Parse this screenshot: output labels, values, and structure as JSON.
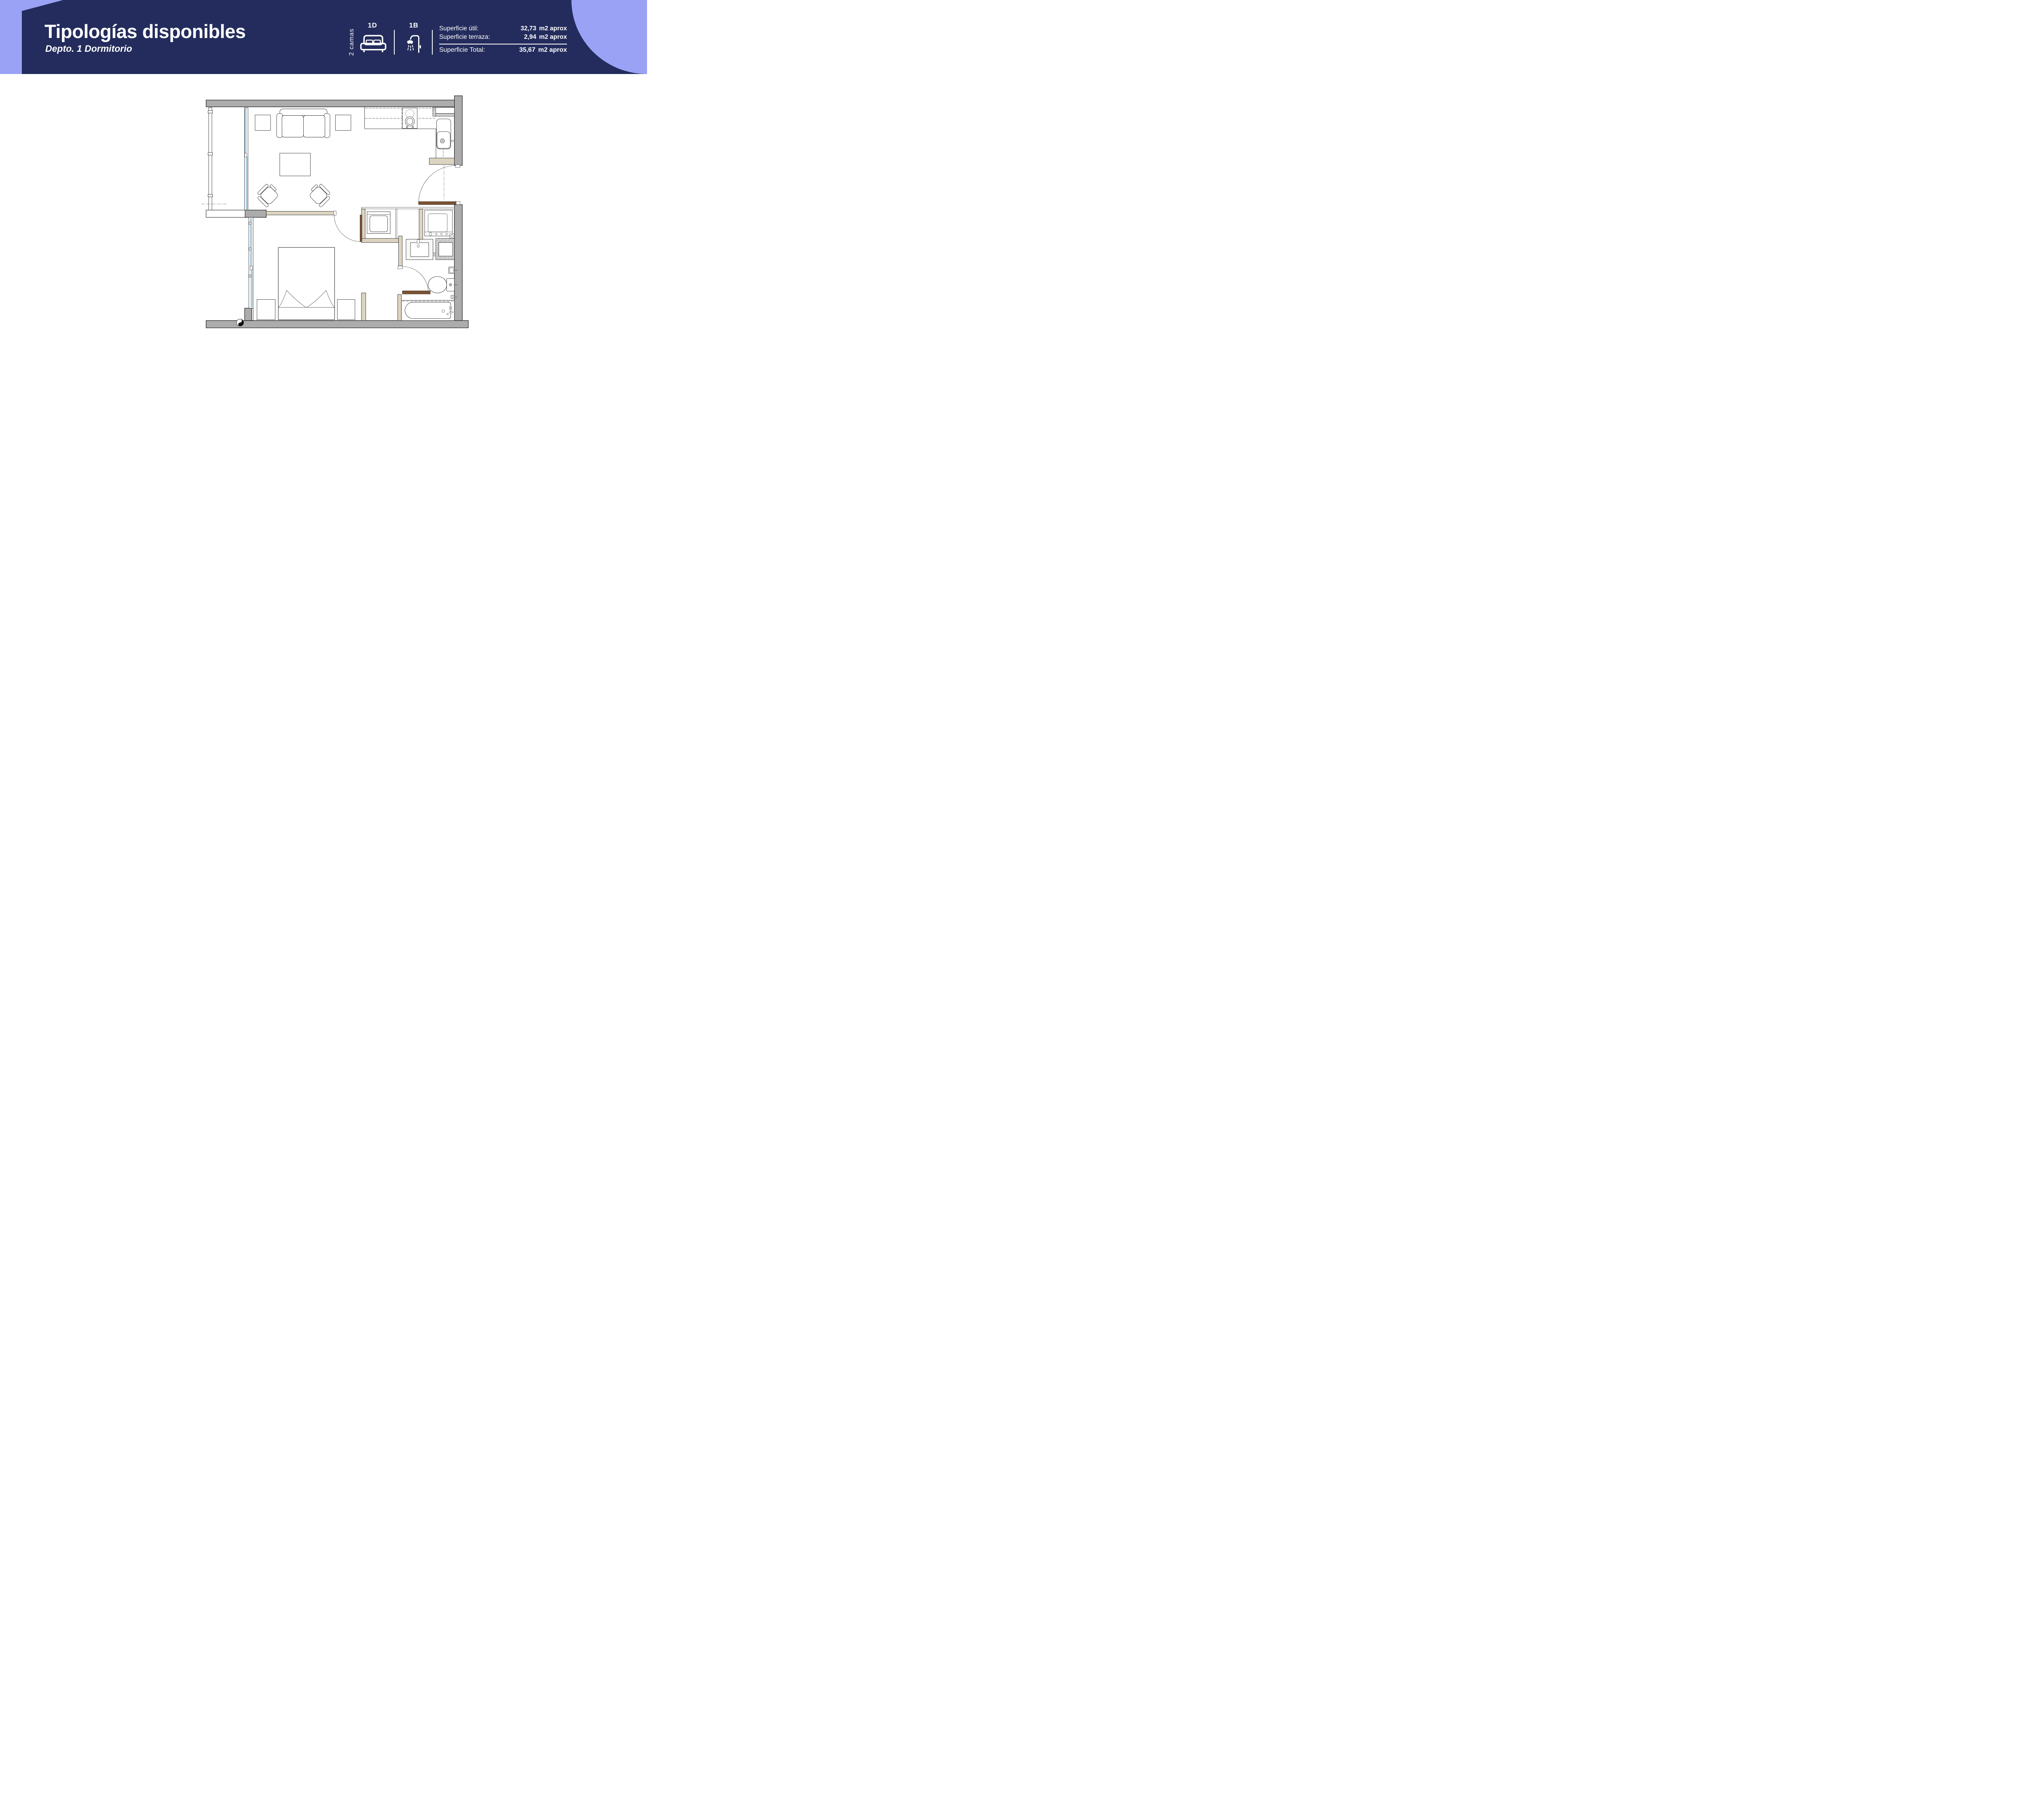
{
  "header": {
    "title": "Tipologías disponibles",
    "subtitle": "Depto. 1 Dormitorio",
    "beds_label": "2 camas",
    "bedrooms_code": "1D",
    "bathrooms_code": "1B",
    "areas": [
      {
        "label": "Superficie útil:",
        "value": "32,73",
        "unit": "m2 aprox"
      },
      {
        "label": "Superficie terraza:",
        "value": "2,94",
        "unit": "m2 aprox"
      },
      {
        "label": "Superficie Total:",
        "value": "35,67",
        "unit": "m2 aprox"
      }
    ],
    "colors": {
      "banner_navy": "#232c5c",
      "band_lavender": "#9aa2f6",
      "text": "#ffffff"
    },
    "icons": [
      "double-bed-icon",
      "shower-icon"
    ]
  },
  "floorplan": {
    "rooms": [
      "living",
      "kitchen",
      "terrace",
      "bedroom",
      "bathroom",
      "laundry-closet"
    ],
    "colors": {
      "wall_gray": "#acacac",
      "partition_tan": "#dcd4c0",
      "door_brown": "#7b5232",
      "glazing_blue": "#bcdbec",
      "line": "#1a1a1a"
    }
  }
}
